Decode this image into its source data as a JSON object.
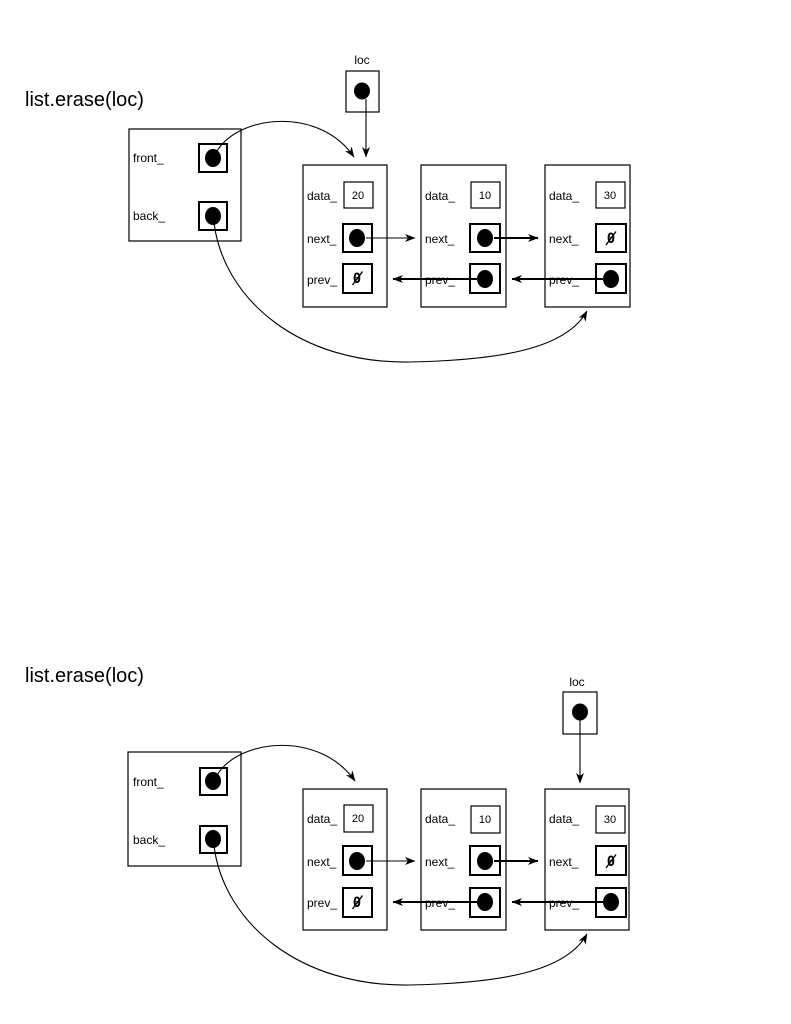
{
  "page": {
    "background": "#ffffff",
    "line_color": "#000000"
  },
  "diagrams": [
    {
      "title": "list.erase(loc)",
      "loc_pointer": {
        "label": "loc"
      },
      "list_object": {
        "front_label": "front_",
        "back_label": "back_"
      },
      "nodes": [
        {
          "data_label": "data_",
          "data_value": "20",
          "next_label": "next_",
          "prev_label": "prev_",
          "prev_value": "0"
        },
        {
          "data_label": "data_",
          "data_value": "10",
          "next_label": "next_",
          "prev_label": "prev_"
        },
        {
          "data_label": "data_",
          "data_value": "30",
          "next_label": "next_",
          "next_value": "0",
          "prev_label": "prev_"
        }
      ]
    },
    {
      "title": "list.erase(loc)",
      "loc_pointer": {
        "label": "loc"
      },
      "list_object": {
        "front_label": "front_",
        "back_label": "back_"
      },
      "nodes": [
        {
          "data_label": "data_",
          "data_value": "20",
          "next_label": "next_",
          "prev_label": "prev_",
          "prev_value": "0"
        },
        {
          "data_label": "data_",
          "data_value": "10",
          "next_label": "next_",
          "prev_label": "prev_"
        },
        {
          "data_label": "data_",
          "data_value": "30",
          "next_label": "next_",
          "next_value": "0",
          "prev_label": "prev_"
        }
      ]
    }
  ]
}
